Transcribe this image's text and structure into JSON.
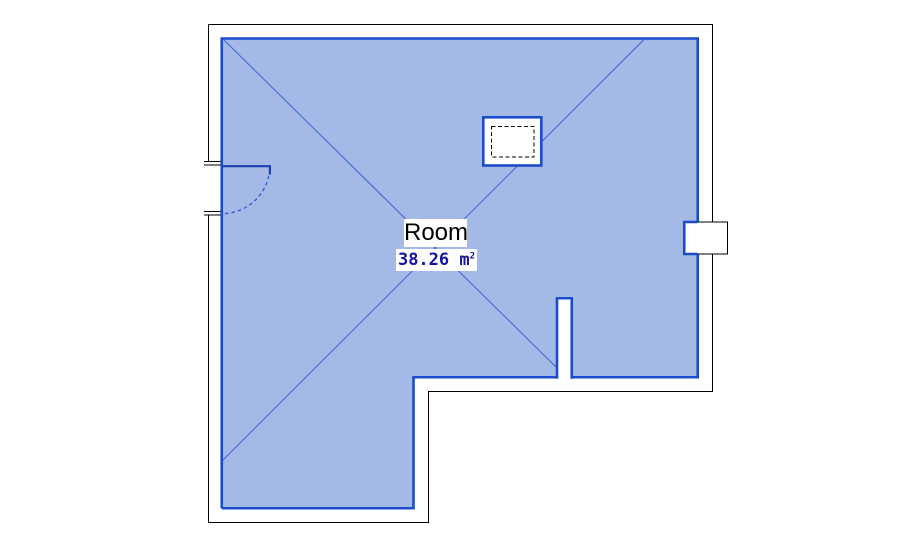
{
  "room": {
    "label": "Room",
    "area_text": "38.26 m",
    "area_exponent": "2"
  },
  "colors": {
    "background": "#ffffff",
    "room_fill": "#a5b9e6",
    "room_boundary": "#1a4ccc",
    "reference_lines": "#3a64d0",
    "wall_outline": "#000000",
    "door_panel": "#1c40ae",
    "door_swing_arc": "#2e58c8",
    "room_label_text": "#000000",
    "area_label_text": "#14149c"
  }
}
